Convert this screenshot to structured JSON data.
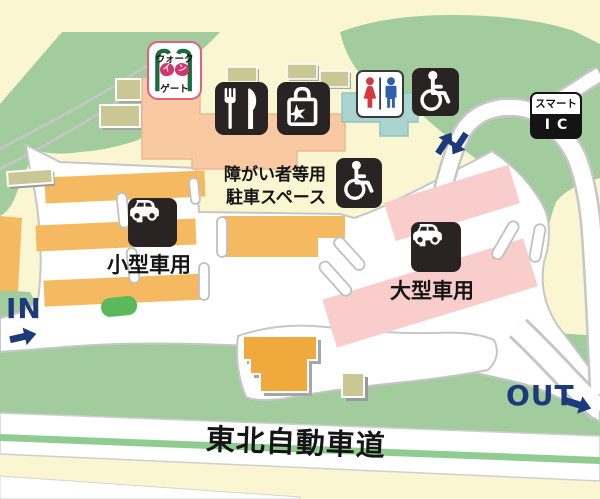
{
  "map_title": "高速道路サービスエリア案内図",
  "labels": {
    "in": "IN",
    "out": "OUT",
    "small_vehicle_parking": "小型車用",
    "large_vehicle_parking": "大型車用",
    "accessible_parking_line1": "障がい者等用",
    "accessible_parking_line2": "駐車スペース",
    "highway_name": "東北自動車道",
    "parking_letter": "P"
  },
  "signs": {
    "walk_gate": {
      "line1": "ウォーク",
      "line2_a": "イ",
      "line2_b": "ン",
      "line3": "ゲート"
    },
    "smart_ic": {
      "line1": "スマート",
      "line2": "IC"
    }
  },
  "icons": {
    "restaurant-icon": "fork-and-knife",
    "shopping-icon": "shopping-bag",
    "restroom-icon": "male-female-figures",
    "wheelchair-icon": "wheelchair",
    "accessible-parking-wheelchair-icon": "wheelchair",
    "small-parking-icon": "P-with-car",
    "large-parking-icon": "P-with-car",
    "walk-gate-posts-icon": "gate-posts",
    "in-arrow-icon": "chunky-arrow",
    "out-arrow-icon": "chunky-arrow",
    "smart-ic-up-arrow-icon": "chunky-arrow",
    "smart-ic-down-arrow-icon": "chunky-arrow"
  },
  "colors": {
    "background_cream": "#faf6d2",
    "terrain_green": "#a2cc9e",
    "island_green": "#5cb85c",
    "median_green": "#90cb90",
    "road_white": "#ffffff",
    "road_edge_gray": "#c6c6c6",
    "small_parking_orange": "#f5ba61",
    "large_parking_pink": "#f9cdcb",
    "facility_salmon": "#f8c9a2",
    "restroom_blue": "#a9d4d0",
    "building_khaki": "#c9c794",
    "icon_black": "#292323",
    "accent_navy": "#1d3a7d",
    "restroom_red": "#d63840",
    "restroom_man_blue": "#2d5fae",
    "gate_green": "#1c6b3c",
    "gate_pink": "#d5356f"
  }
}
